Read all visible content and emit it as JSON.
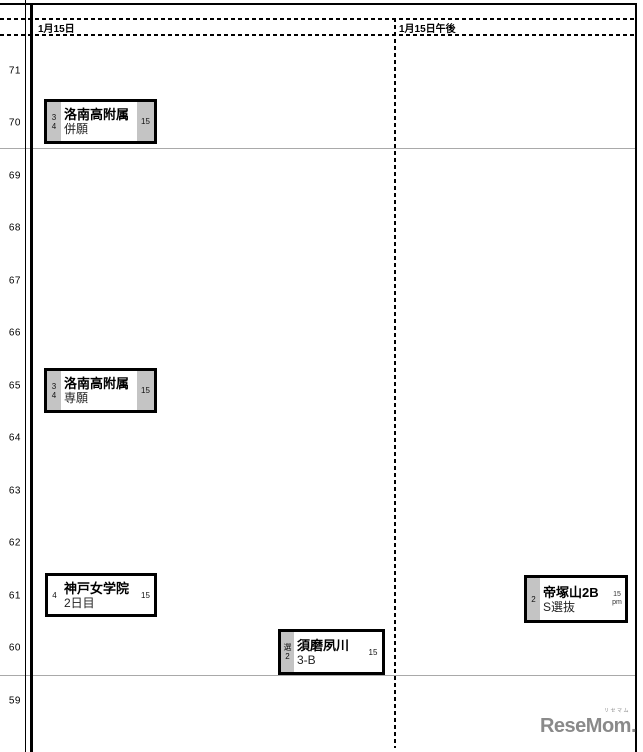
{
  "chart_data": {
    "type": "scatter",
    "x_categories": [
      "1月15日",
      "1月15日午後"
    ],
    "y_axis": {
      "values": [
        71,
        70,
        69,
        68,
        67,
        66,
        65,
        64,
        63,
        62,
        61,
        60,
        59
      ],
      "range": [
        59,
        71
      ]
    },
    "separator_lines_y": [
      69.5,
      59.5
    ],
    "points": [
      {
        "column": "1月15日",
        "deviation": 70,
        "name": "洛南高附属",
        "course": "併願",
        "left_labels": [
          "3",
          "4"
        ],
        "right_labels": [
          "15"
        ],
        "left_shaded": true,
        "right_shaded": true
      },
      {
        "column": "1月15日",
        "deviation": 65,
        "name": "洛南高附属",
        "course": "専願",
        "left_labels": [
          "3",
          "4"
        ],
        "right_labels": [
          "15"
        ],
        "left_shaded": true,
        "right_shaded": true
      },
      {
        "column": "1月15日",
        "deviation": 61,
        "name": "神戸女学院",
        "course": "2日目",
        "left_labels": [
          "4"
        ],
        "right_labels": [
          "15"
        ],
        "left_shaded": false,
        "right_shaded": false
      },
      {
        "column": "1月15日",
        "deviation": 60,
        "name": "須磨夙川",
        "course": "3-B",
        "left_labels": [
          "選",
          "2"
        ],
        "right_labels": [
          "15"
        ],
        "left_shaded": true,
        "right_shaded": false
      },
      {
        "column": "1月15日午後",
        "deviation": 61,
        "name": "帝塚山2B",
        "course": "S選抜",
        "left_labels": [
          "2"
        ],
        "right_labels": [
          "15",
          "pm"
        ],
        "left_shaded": true,
        "right_shaded": false
      }
    ]
  },
  "logo": {
    "ruby": "リセマム",
    "text": "ReseMom."
  },
  "colors": {
    "shaded_cell": "#c4c4c4",
    "band_line": "#a9a9a9",
    "logo": "#8a8a8a"
  }
}
